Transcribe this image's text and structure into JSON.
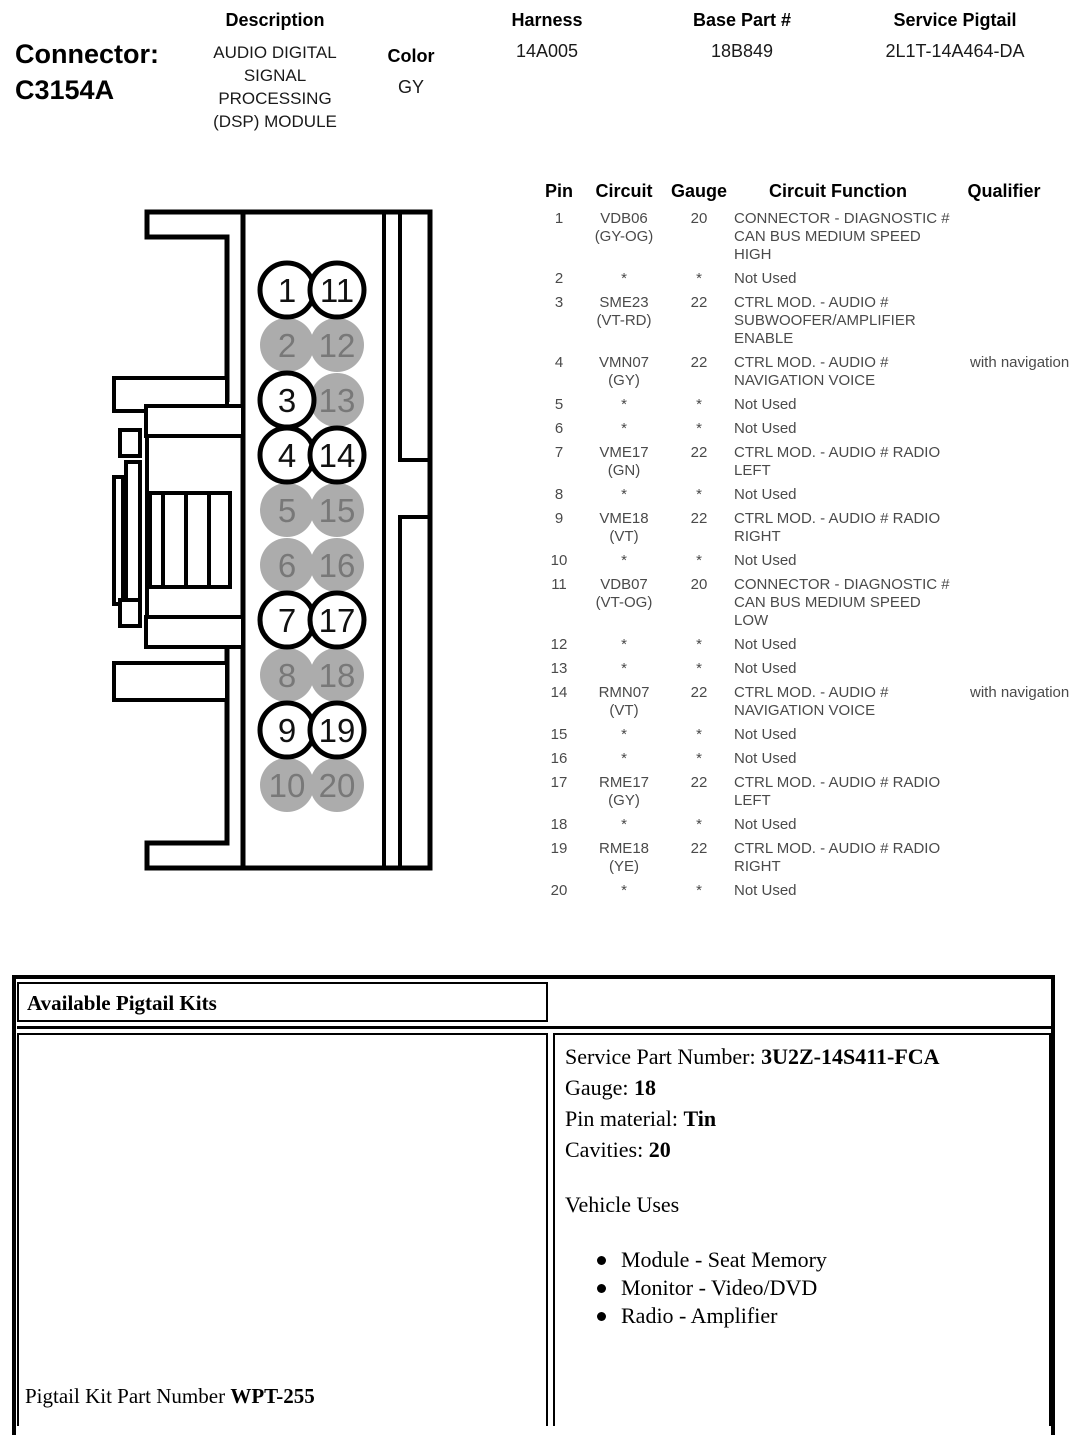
{
  "header": {
    "connector_label": "Connector:",
    "connector_id": "C3154A",
    "description_label": "Description",
    "description": "AUDIO DIGITAL SIGNAL PROCESSING (DSP) MODULE",
    "color_label": "Color",
    "color": "GY",
    "harness_label": "Harness",
    "harness": "14A005",
    "base_part_label": "Base Part #",
    "base_part": "18B849",
    "service_pigtail_label": "Service Pigtail",
    "service_pigtail": "2L1T-14A464-DA"
  },
  "connector_diagram": {
    "pins": [
      {
        "label": "1",
        "used": true
      },
      {
        "label": "2",
        "used": false
      },
      {
        "label": "3",
        "used": true
      },
      {
        "label": "4",
        "used": true
      },
      {
        "label": "5",
        "used": false
      },
      {
        "label": "6",
        "used": false
      },
      {
        "label": "7",
        "used": true
      },
      {
        "label": "8",
        "used": false
      },
      {
        "label": "9",
        "used": true
      },
      {
        "label": "10",
        "used": false
      },
      {
        "label": "11",
        "used": true
      },
      {
        "label": "12",
        "used": false
      },
      {
        "label": "13",
        "used": false
      },
      {
        "label": "14",
        "used": true
      },
      {
        "label": "15",
        "used": false
      },
      {
        "label": "16",
        "used": false
      },
      {
        "label": "17",
        "used": true
      },
      {
        "label": "18",
        "used": false
      },
      {
        "label": "19",
        "used": true
      },
      {
        "label": "20",
        "used": false
      }
    ]
  },
  "pin_table": {
    "headers": {
      "pin": "Pin",
      "circuit": "Circuit",
      "gauge": "Gauge",
      "function": "Circuit Function",
      "qualifier": "Qualifier"
    },
    "rows": [
      {
        "pin": "1",
        "circuit": "VDB06",
        "color": "(GY-OG)",
        "gauge": "20",
        "func": "CONNECTOR - DIAGNOSTIC # CAN BUS MEDIUM SPEED HIGH",
        "qual": ""
      },
      {
        "pin": "2",
        "circuit": "*",
        "color": "",
        "gauge": "*",
        "func": "Not Used",
        "qual": ""
      },
      {
        "pin": "3",
        "circuit": "SME23",
        "color": "(VT-RD)",
        "gauge": "22",
        "func": "CTRL MOD. - AUDIO # SUBWOOFER/AMPLIFIER ENABLE",
        "qual": ""
      },
      {
        "pin": "4",
        "circuit": "VMN07",
        "color": "(GY)",
        "gauge": "22",
        "func": "CTRL MOD. - AUDIO # NAVIGATION VOICE",
        "qual": "with navigation"
      },
      {
        "pin": "5",
        "circuit": "*",
        "color": "",
        "gauge": "*",
        "func": "Not Used",
        "qual": ""
      },
      {
        "pin": "6",
        "circuit": "*",
        "color": "",
        "gauge": "*",
        "func": "Not Used",
        "qual": ""
      },
      {
        "pin": "7",
        "circuit": "VME17",
        "color": "(GN)",
        "gauge": "22",
        "func": "CTRL MOD. - AUDIO # RADIO LEFT",
        "qual": ""
      },
      {
        "pin": "8",
        "circuit": "*",
        "color": "",
        "gauge": "*",
        "func": "Not Used",
        "qual": ""
      },
      {
        "pin": "9",
        "circuit": "VME18",
        "color": "(VT)",
        "gauge": "22",
        "func": "CTRL MOD. - AUDIO # RADIO RIGHT",
        "qual": ""
      },
      {
        "pin": "10",
        "circuit": "*",
        "color": "",
        "gauge": "*",
        "func": "Not Used",
        "qual": ""
      },
      {
        "pin": "11",
        "circuit": "VDB07",
        "color": "(VT-OG)",
        "gauge": "20",
        "func": "CONNECTOR - DIAGNOSTIC # CAN BUS MEDIUM SPEED LOW",
        "qual": ""
      },
      {
        "pin": "12",
        "circuit": "*",
        "color": "",
        "gauge": "*",
        "func": "Not Used",
        "qual": ""
      },
      {
        "pin": "13",
        "circuit": "*",
        "color": "",
        "gauge": "*",
        "func": "Not Used",
        "qual": ""
      },
      {
        "pin": "14",
        "circuit": "RMN07",
        "color": "(VT)",
        "gauge": "22",
        "func": "CTRL MOD. - AUDIO # NAVIGATION VOICE",
        "qual": "with navigation"
      },
      {
        "pin": "15",
        "circuit": "*",
        "color": "",
        "gauge": "*",
        "func": "Not Used",
        "qual": ""
      },
      {
        "pin": "16",
        "circuit": "*",
        "color": "",
        "gauge": "*",
        "func": "Not Used",
        "qual": ""
      },
      {
        "pin": "17",
        "circuit": "RME17",
        "color": "(GY)",
        "gauge": "22",
        "func": "CTRL MOD. - AUDIO # RADIO LEFT",
        "qual": ""
      },
      {
        "pin": "18",
        "circuit": "*",
        "color": "",
        "gauge": "*",
        "func": "Not Used",
        "qual": ""
      },
      {
        "pin": "19",
        "circuit": "RME18",
        "color": "(YE)",
        "gauge": "22",
        "func": "CTRL MOD. - AUDIO # RADIO RIGHT",
        "qual": ""
      },
      {
        "pin": "20",
        "circuit": "*",
        "color": "",
        "gauge": "*",
        "func": "Not Used",
        "qual": ""
      }
    ]
  },
  "pigtail": {
    "title": "Available Pigtail Kits",
    "service_part_label": "Service Part Number: ",
    "service_part": "3U2Z-14S411-FCA",
    "gauge_label": "Gauge: ",
    "gauge": "18",
    "pin_material_label": "Pin material: ",
    "pin_material": "Tin",
    "cavities_label": "Cavities: ",
    "cavities": "20",
    "vehicle_uses_label": "Vehicle Uses",
    "vehicle_uses": [
      "Module - Seat Memory",
      "Monitor - Video/DVD",
      "Radio - Amplifier"
    ],
    "kit_label": "Pigtail Kit Part Number ",
    "kit_number": "WPT-255"
  },
  "colors": {
    "pin_unused_fill": "#acacac",
    "pin_unused_text": "#787878",
    "pin_used_fill": "#ffffff",
    "pin_used_stroke": "#000000",
    "pin_used_text": "#111111",
    "table_text": "#4a4a4a"
  }
}
